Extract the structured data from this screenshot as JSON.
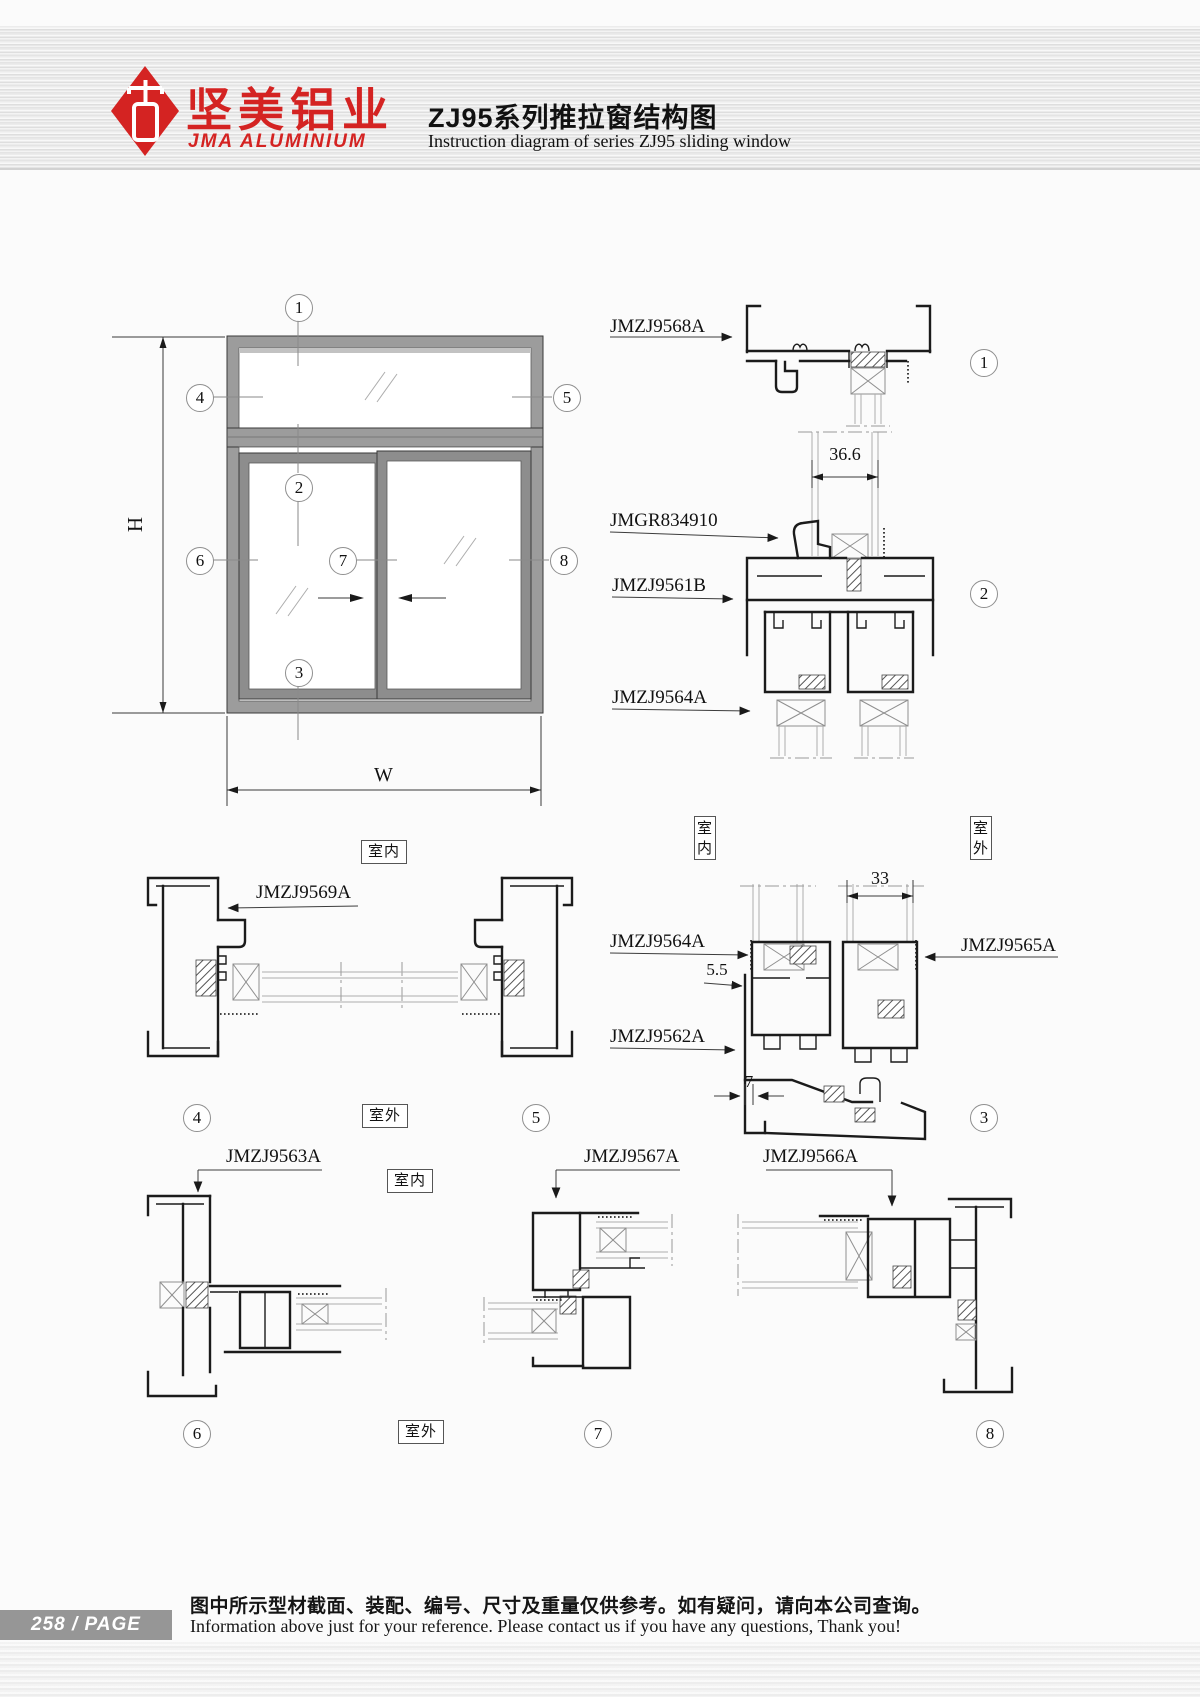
{
  "header": {
    "brand_cn": "坚美铝业",
    "brand_en": "JMA ALUMINIUM",
    "title_cn": "ZJ95系列推拉窗结构图",
    "title_en": "Instruction diagram of series ZJ95 sliding window"
  },
  "labels": {
    "indoor": "室内",
    "outdoor": "室外"
  },
  "dims": {
    "h": "H",
    "w": "W",
    "d366": "36.6",
    "d33": "33",
    "d55": "5.5",
    "d7": "7"
  },
  "callouts": {
    "n1": "1",
    "n2": "2",
    "n3": "3",
    "n4": "4",
    "n5": "5",
    "n6": "6",
    "n7": "7",
    "n8": "8"
  },
  "parts": {
    "p9568": "JMZJ9568A",
    "pgr": "JMGR834910",
    "p9561": "JMZJ9561B",
    "p9564_s2": "JMZJ9564A",
    "p9564_s3": "JMZJ9564A",
    "p9565": "JMZJ9565A",
    "p9562": "JMZJ9562A",
    "p9569": "JMZJ9569A",
    "p9563": "JMZJ9563A",
    "p9567": "JMZJ9567A",
    "p9566": "JMZJ9566A"
  },
  "footer": {
    "page_label": "258 / PAGE",
    "note_cn": "图中所示型材截面、装配、编号、尺寸及重量仅供参考。如有疑问，请向本公司查询。",
    "note_en": "Information above just for your reference. Please contact us if you have any questions, Thank you!"
  }
}
